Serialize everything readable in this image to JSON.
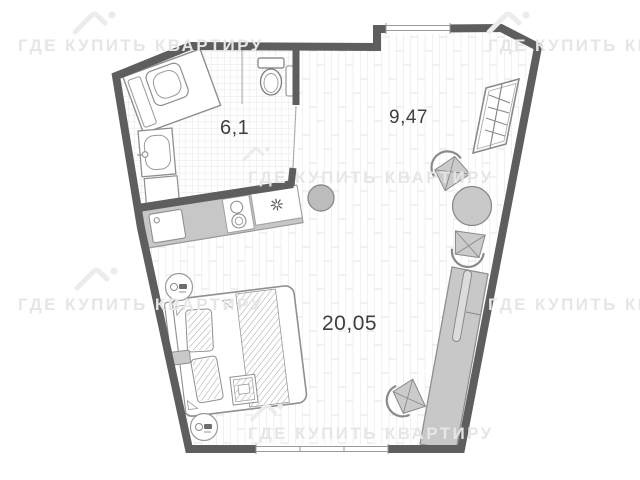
{
  "page": {
    "type": "apartment-floor-plan"
  },
  "watermark": {
    "text": "ГДЕ КУПИТЬ КВАРТИРУ",
    "logo": "house-roof-with-dot"
  },
  "rooms": [
    {
      "id": "bathroom",
      "area": "6,1"
    },
    {
      "id": "entry-zone",
      "area": "9,47"
    },
    {
      "id": "living-room",
      "area": "20,05"
    }
  ],
  "furniture": [
    "washing-machine",
    "bathroom-sink",
    "toilet",
    "kitchen-counter",
    "kitchen-sink",
    "two-burner-stove",
    "star-symbol",
    "pouf",
    "wardrobe-with-hangers",
    "dining-table",
    "dining-chair",
    "dining-chair",
    "bed-with-pillows",
    "nightstand",
    "ceiling-lamp",
    "ceiling-lamp",
    "desk-console",
    "tv",
    "desk-chair"
  ],
  "colors": {
    "wall": "#5e5e5e",
    "furniture_fill": "#c7c7c7",
    "floor_line": "#e3e3e3",
    "tile_line": "#e6e6e6",
    "outline": "#8a8a8a",
    "label": "#3f3f3f",
    "watermark": "#e6e6e6"
  }
}
